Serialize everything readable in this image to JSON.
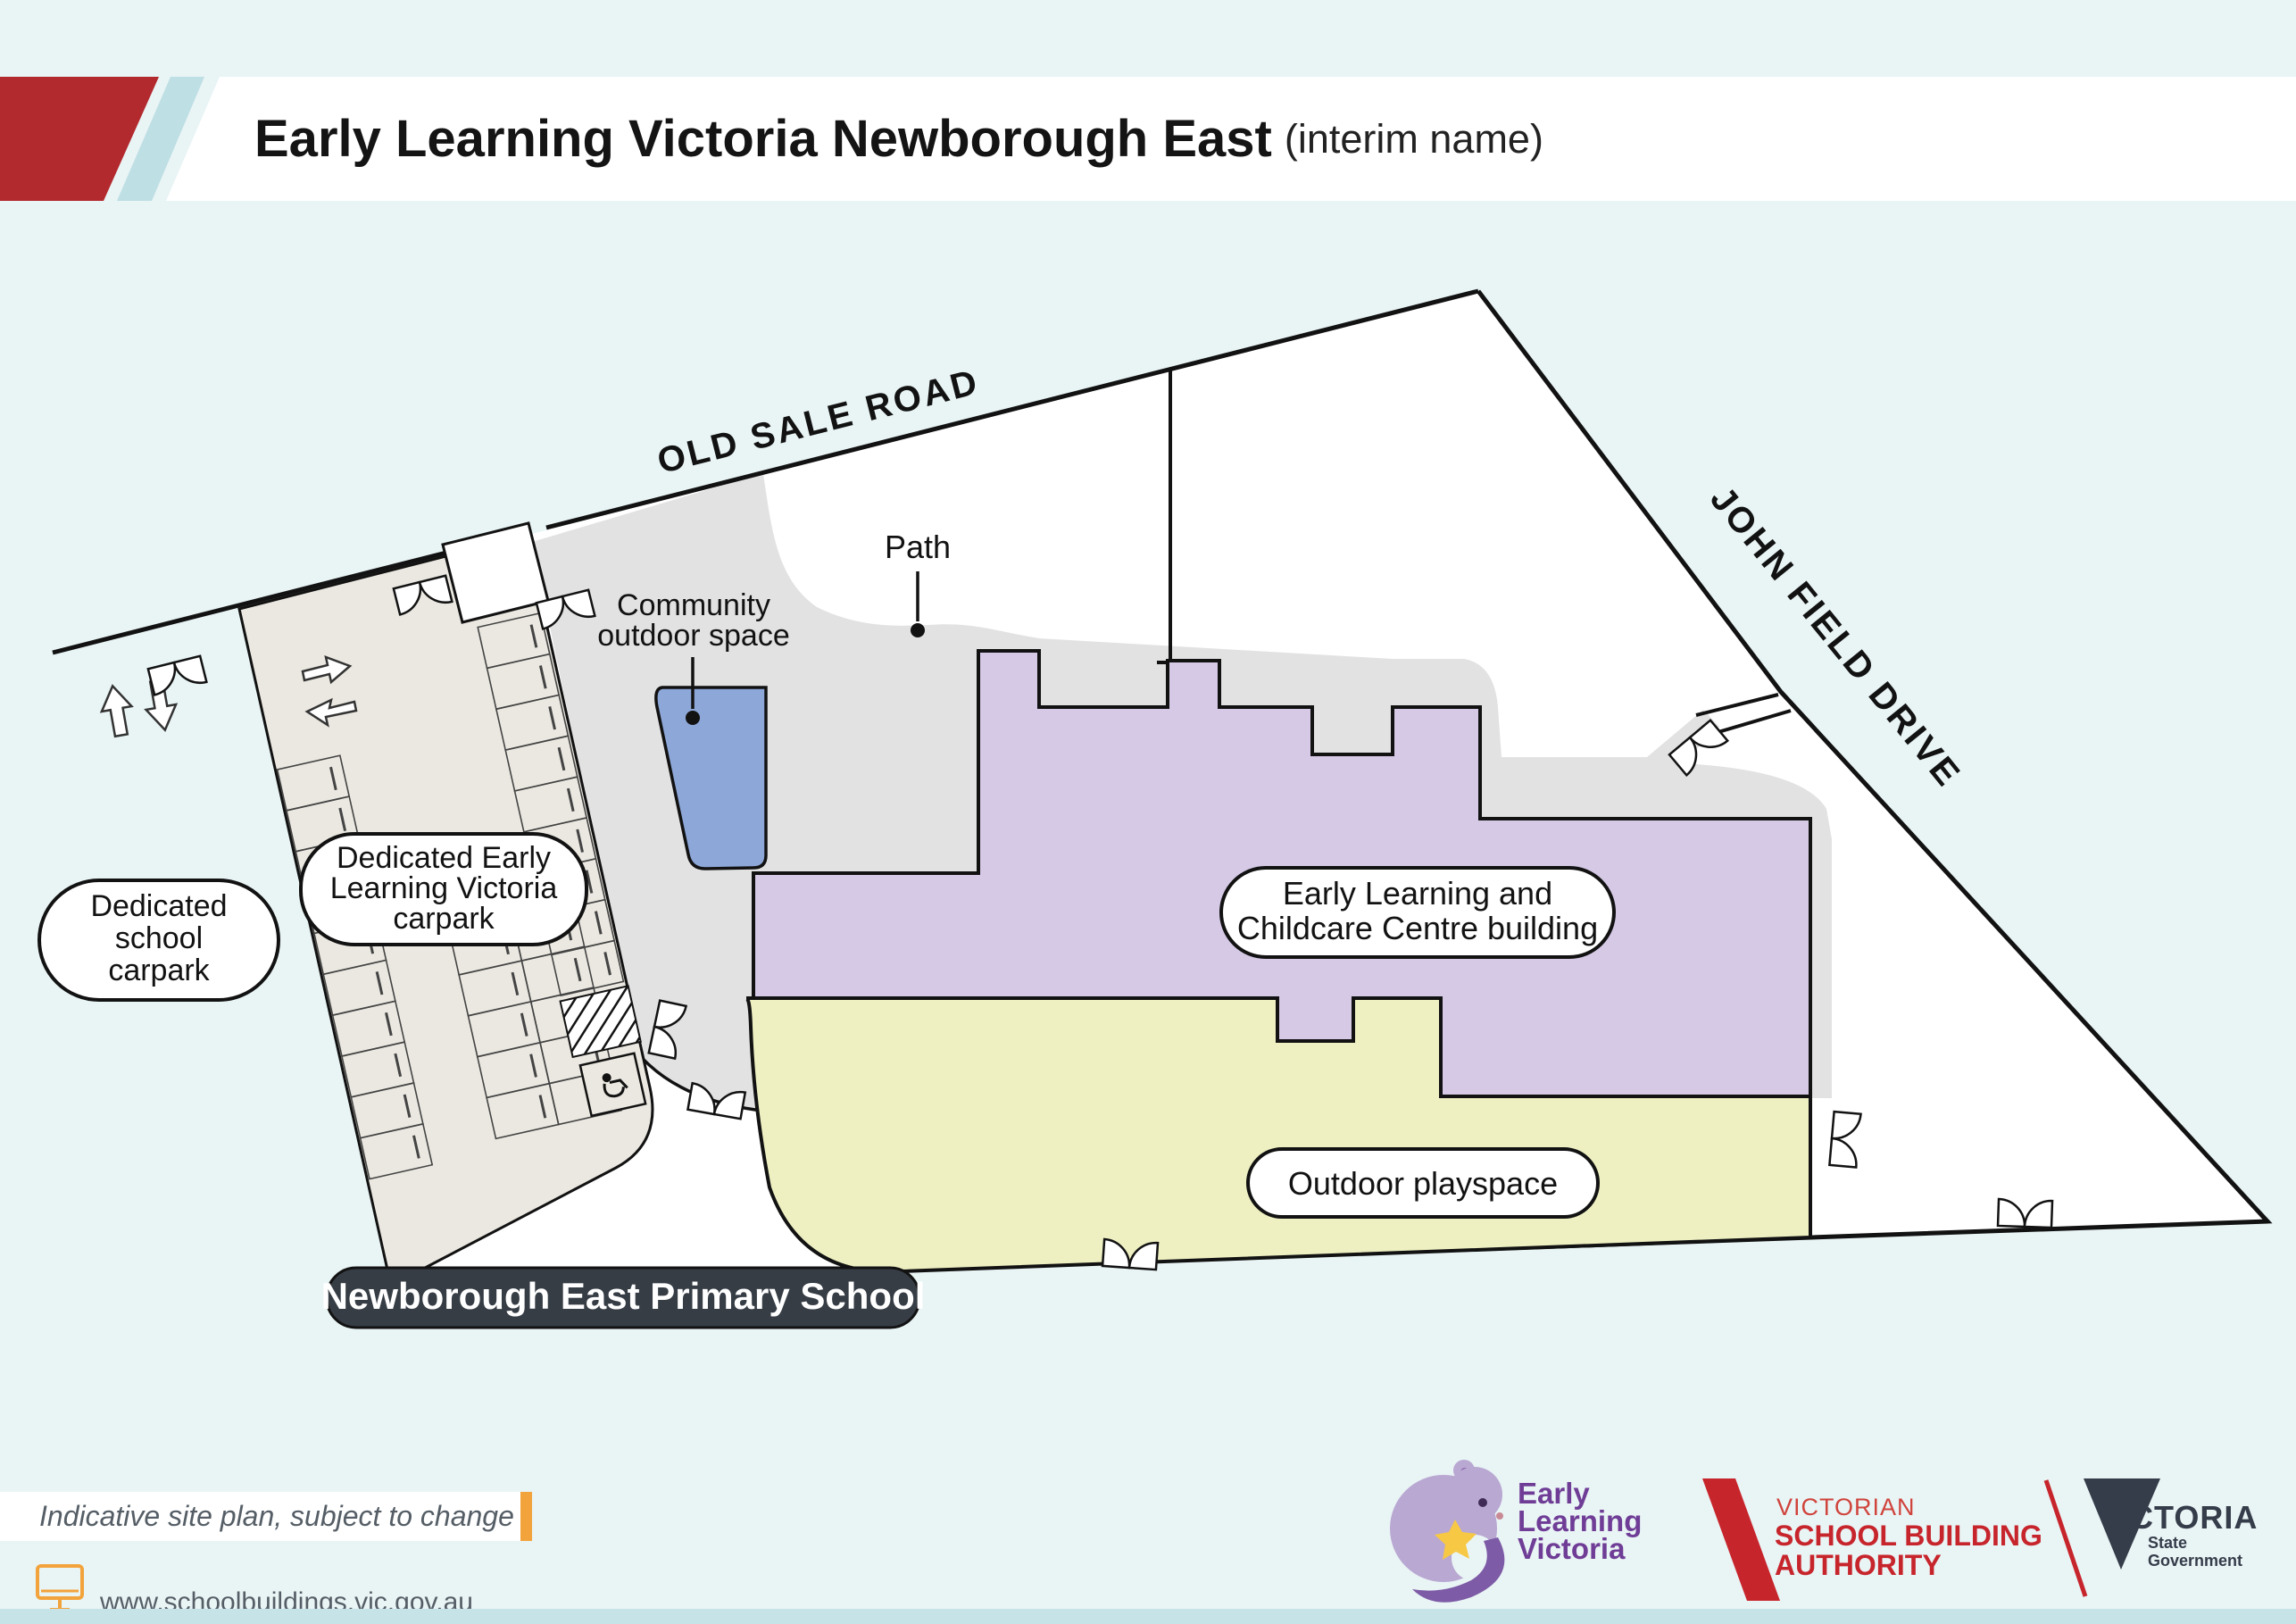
{
  "header": {
    "title": "Early Learning Victoria Newborough East",
    "subtitle": "(interim name)"
  },
  "map": {
    "roads": {
      "old_sale_road": "OLD SALE ROAD",
      "john_field_drive": "JOHN FIELD DRIVE"
    },
    "labels": {
      "path": "Path",
      "community_outdoor_space": [
        "Community",
        "outdoor space"
      ],
      "dedicated_school_carpark": [
        "Dedicated",
        "school",
        "carpark"
      ],
      "dedicated_elv_carpark": [
        "Dedicated Early",
        "Learning Victoria",
        "carpark"
      ],
      "centre_building": [
        "Early Learning and",
        "Childcare Centre building"
      ],
      "outdoor_playspace": "Outdoor playspace",
      "primary_school": "Newborough East Primary School"
    }
  },
  "footer": {
    "disclaimer": "Indicative site plan, subject to change",
    "website": "www.schoolbuildings.vic.gov.au"
  },
  "logos": {
    "elv": [
      "Early",
      "Learning",
      "Victoria"
    ],
    "vsba": [
      "VICTORIAN",
      "SCHOOL BUILDING",
      "AUTHORITY"
    ],
    "vic": [
      "VICTORIA",
      "State",
      "Government"
    ]
  },
  "colors": {
    "page_bg": "#e9f4f5",
    "bottom_strip": "#c6e3e7",
    "header_red": "#b2292e",
    "header_stripe": "#bedfe4",
    "accent_orange": "#f2a33c",
    "carpark_fill": "#ebe8e1",
    "plaza_gray": "#e3e2e2",
    "community_blue": "#8da7d8",
    "building_purple": "#d5c9e6",
    "playspace_yellow": "#eef0c2",
    "school_pill": "#363d45",
    "elv_purple": "#6f3d96",
    "vsba_red": "#c7252c",
    "vic_navy": "#353c4a"
  }
}
